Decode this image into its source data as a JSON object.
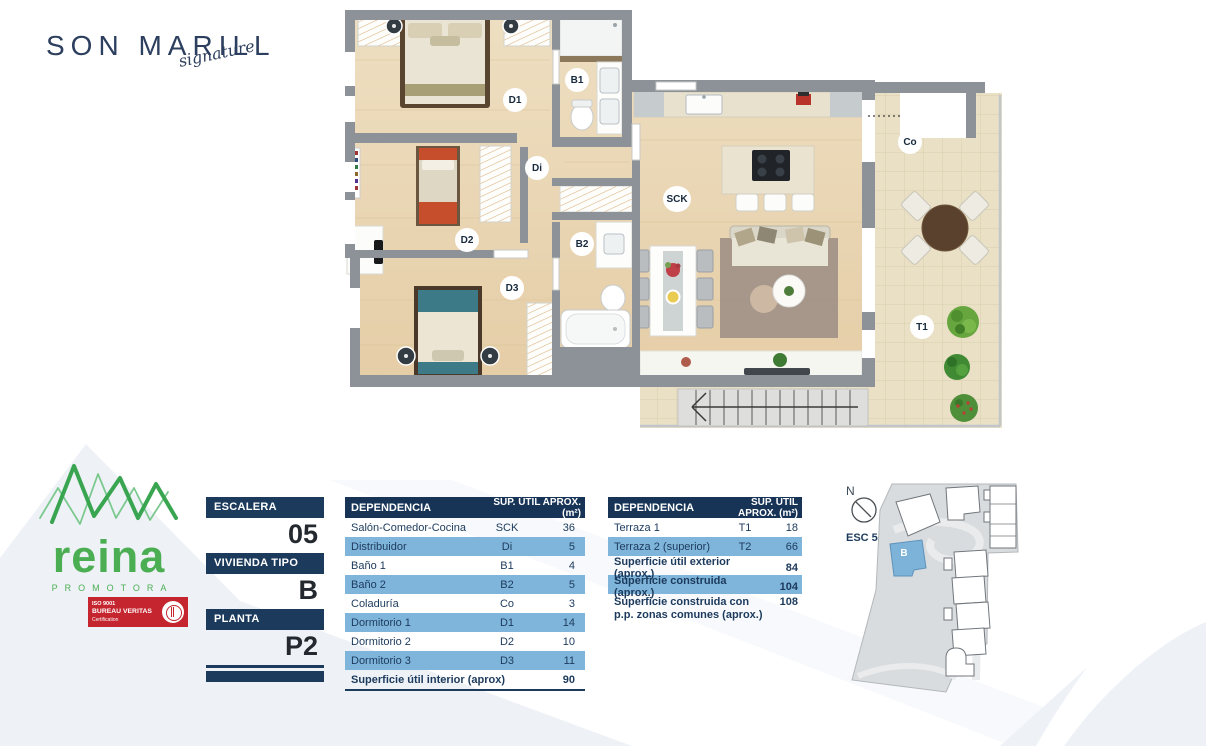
{
  "brand": {
    "title": "SON MARILL",
    "subtitle": "signature"
  },
  "developer": {
    "name": "reina",
    "tagline": "PROMOTORA",
    "badge": {
      "iso": "ISO 9001",
      "org": "BUREAU VERITAS",
      "cert": "Certification"
    }
  },
  "unit": {
    "fields": [
      {
        "label": "ESCALERA",
        "value": "05"
      },
      {
        "label": "VIVIENDA TIPO",
        "value": "B"
      },
      {
        "label": "PLANTA",
        "value": "P2"
      }
    ]
  },
  "floorplan": {
    "labels": [
      {
        "code": "D1"
      },
      {
        "code": "B1"
      },
      {
        "code": "Di"
      },
      {
        "code": "D2"
      },
      {
        "code": "B2"
      },
      {
        "code": "D3"
      },
      {
        "code": "SCK"
      },
      {
        "code": "Co"
      },
      {
        "code": "T1"
      }
    ]
  },
  "tables": {
    "interior": {
      "col_room": "DEPENDENCIA",
      "col_area": "SUP. ÚTIL APROX. (m²)",
      "rows": [
        {
          "name": "Salón-Comedor-Cocina",
          "code": "SCK",
          "value": "36"
        },
        {
          "name": "Distribuidor",
          "code": "Di",
          "value": "5"
        },
        {
          "name": "Baño 1",
          "code": "B1",
          "value": "4"
        },
        {
          "name": "Baño 2",
          "code": "B2",
          "value": "5"
        },
        {
          "name": "Coladuría",
          "code": "Co",
          "value": "3"
        },
        {
          "name": "Dormitorio 1",
          "code": "D1",
          "value": "14"
        },
        {
          "name": "Dormitorio 2",
          "code": "D2",
          "value": "10"
        },
        {
          "name": "Dormitorio 3",
          "code": "D3",
          "value": "11"
        }
      ],
      "total": {
        "name": "Superficie útil interior (aprox)",
        "value": "90"
      }
    },
    "exterior": {
      "col_room": "DEPENDENCIA",
      "col_area": "SUP. ÚTIL APROX. (m²)",
      "rows": [
        {
          "name": "Terraza 1",
          "code": "T1",
          "value": "18"
        },
        {
          "name": "Terraza 2 (superior)",
          "code": "T2",
          "value": "66"
        }
      ],
      "summary": [
        {
          "name": "Superficie útil exterior (aprox.)",
          "value": "84"
        },
        {
          "name": "Superficie construida (aprox.)",
          "value": "104"
        },
        {
          "name": "Superficie construida con p.p. zonas comunes (aprox.)",
          "value": "108"
        }
      ]
    }
  },
  "sitemap": {
    "north": "N",
    "esc": "ESC 5",
    "building": "B"
  },
  "colors": {
    "navy": "#1c3a5c",
    "row_blue": "#7fb5db",
    "green": "#4bae53",
    "red": "#c5252f",
    "highlight_blue": "#7db3d9"
  }
}
